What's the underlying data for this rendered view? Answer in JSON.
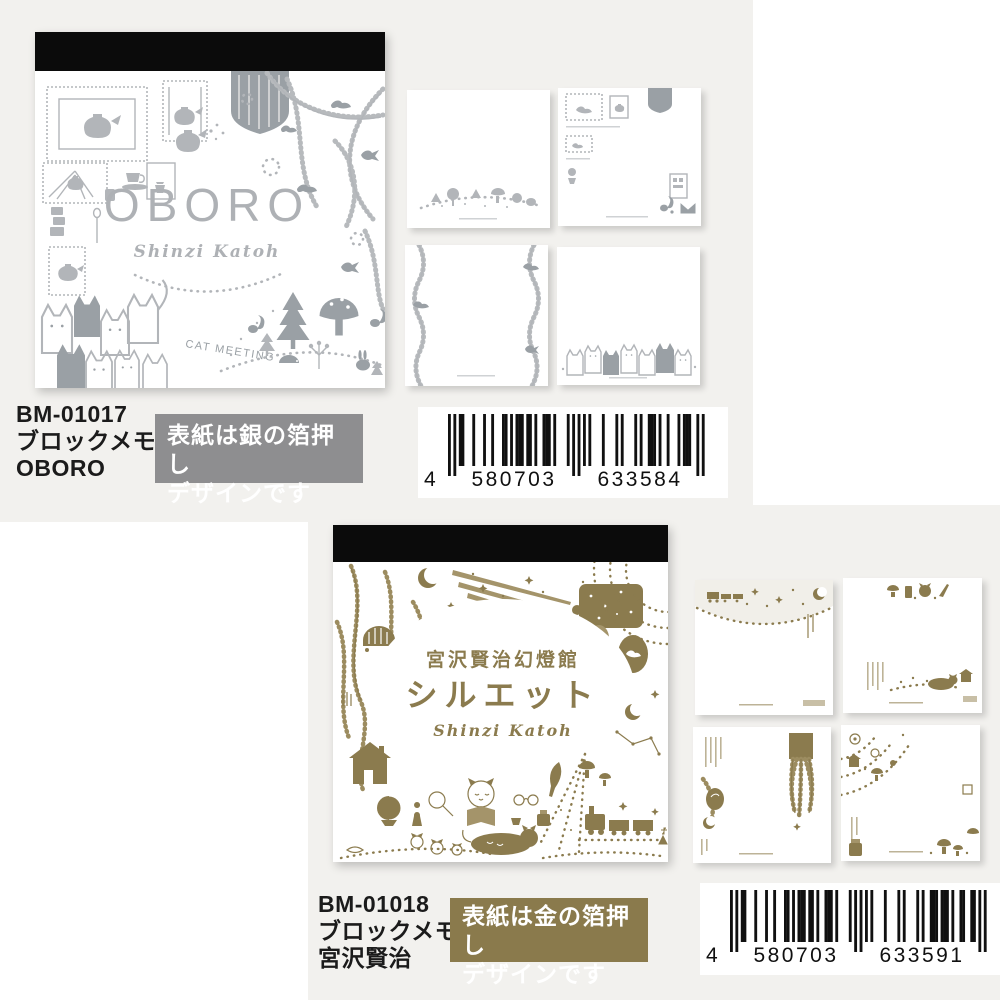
{
  "page": {
    "background": "#ffffff",
    "panel_color": "#f2f1ee"
  },
  "products": [
    {
      "code": "BM-01017",
      "type": "ブロックメモ",
      "name": "OBORO",
      "badge": {
        "line1": "表紙は銀の箔押し",
        "line2": "デザインです",
        "bg": "#8e8e90"
      },
      "cover": {
        "title": "OBORO",
        "artist": "Shinzi Katoh",
        "cat_text": "CAT MEETING",
        "accent_color": "#b2b5b9",
        "motifs": [
          "teapot-frame-icon",
          "stamp-teapot-icon",
          "teacup-icon",
          "spoon-icon",
          "vine-bird-icon",
          "cat-group-icon",
          "forest-animals-icon"
        ]
      },
      "barcode": {
        "digits": "4580703633584",
        "display": [
          "4",
          "580703",
          "633584"
        ]
      }
    },
    {
      "code": "BM-01018",
      "type": "ブロックメモ",
      "name": "宮沢賢治",
      "badge": {
        "line1": "表紙は金の箔押し",
        "line2": "デザインです",
        "bg": "#8a7a4c"
      },
      "cover": {
        "subtitle": "宮沢賢治幻燈館",
        "title": "シルエット",
        "artist": "Shinzi Katoh",
        "accent_color": "#8b7b4e",
        "motifs": [
          "crescent-moon-icon",
          "comet-icon",
          "night-window-icon",
          "leafy-branch-icon",
          "house-icon",
          "globe-icon",
          "magnifier-icon",
          "reading-cat-icon",
          "black-cat-icon",
          "steam-train-icon",
          "stars-icon"
        ]
      },
      "barcode": {
        "digits": "4580703633591",
        "display": [
          "4",
          "580703",
          "633591"
        ]
      }
    }
  ]
}
